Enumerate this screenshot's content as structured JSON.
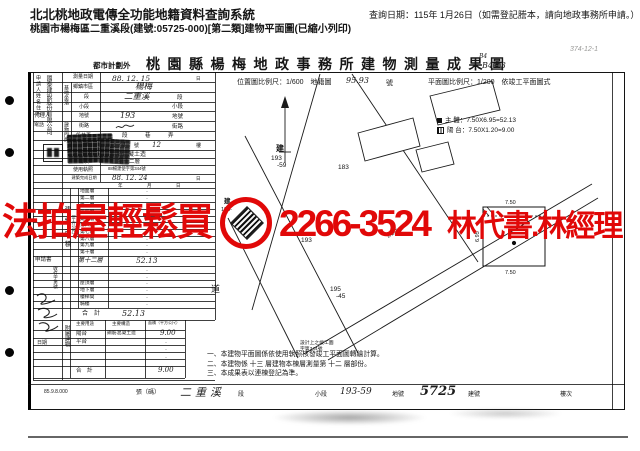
{
  "header": {
    "system_title": "北北桃地政電傳全功能地籍資料查詢系統",
    "query_date": "查詢日期：115年 1月26日（如需登記謄本，請向地政事務所申請。）",
    "subtitle": "桃園市楊梅區二重溪段(建號:05725-000)[第二類]建物平面圖(已縮小列印)"
  },
  "document": {
    "plan_zone": "都市計劃外",
    "title": "桃園縣楊梅地政事務所建物測量成果圖",
    "handwritten_small": "B4",
    "handwritten_code": "B4-13",
    "pencil_note": "374-12-1"
  },
  "form": {
    "applicant_label": "申請人姓名住所",
    "applicant_value": "國泰建設股份有限公司",
    "agent_label": "代理人",
    "phone_label": "電話",
    "receipt_label": "申請書",
    "receipt_no_label": "收件字第號",
    "receipt_date_label": "日期",
    "survey_date": {
      "label": "測量日期",
      "value": "88. 12. 15",
      "unit": "日"
    },
    "site_label": "基地坐落",
    "township": {
      "label": "鄉鎮市區",
      "value": "楊梅"
    },
    "section": {
      "label": "段",
      "value": "二重溪",
      "suffix": "段"
    },
    "subsection": {
      "label": "小段",
      "suffix": "小段"
    },
    "lot": {
      "label": "地號",
      "value": "193",
      "suffix": "地號"
    },
    "address_label": "建物門牌",
    "street": {
      "label": "街路",
      "suffix": "街路"
    },
    "lane": {
      "label": "段巷弄",
      "suffix": "段 巷 弄"
    },
    "number": {
      "label": "號",
      "value": "374",
      "suffix": "號",
      "floor": "12",
      "floor_suffix": "樓"
    },
    "material": {
      "label": "主要建材",
      "value": "鋼筋混凝土造"
    },
    "storey": {
      "label": "層次",
      "value": "第十二層"
    },
    "license": {
      "label": "使用執照",
      "value": "88楊建使字第344號"
    },
    "completion": {
      "label": "建築完成日期",
      "value": "88. 12. 24",
      "unit": "日"
    },
    "date_units": "年　月　日",
    "area_label": "建物面積",
    "area_unit": "（平方公尺）",
    "floors": [
      {
        "name": "地面層",
        "area": "·"
      },
      {
        "name": "第二層",
        "area": "·"
      },
      {
        "name": "第三層",
        "area": "·"
      },
      {
        "name": "第四層",
        "area": "·"
      },
      {
        "name": "第五層",
        "area": "·"
      },
      {
        "name": "第六層",
        "area": "·"
      },
      {
        "name": "第七層",
        "area": "·"
      },
      {
        "name": "第八層",
        "area": "·"
      },
      {
        "name": "第九層",
        "area": "·"
      },
      {
        "name": "第十層",
        "area": "·"
      },
      {
        "name": "第十二層",
        "area": "52.13"
      },
      {
        "name": "",
        "area": "·"
      },
      {
        "name": "",
        "area": "·"
      },
      {
        "name": "屋頂層",
        "area": "·"
      },
      {
        "name": "地下層",
        "area": "·"
      },
      {
        "name": "樓梯間",
        "area": "·"
      },
      {
        "name": "騎樓",
        "area": "·"
      }
    ],
    "total_label": "合　計",
    "total_value": "52.13",
    "annex_label": "附屬建物",
    "annex_headers": [
      "主要用途",
      "主要構造",
      "面積（平方公尺）"
    ],
    "annex_rows": [
      {
        "use": "陽台",
        "structure": "鋼筋混凝土造",
        "area": "9.00"
      },
      {
        "use": "平台",
        "structure": "",
        "area": "·"
      },
      {
        "use": "",
        "structure": "",
        "area": "·"
      },
      {
        "use": "",
        "structure": "",
        "area": "·"
      }
    ],
    "annex_total_label": "合　計",
    "annex_total_value": "9.00",
    "print_code": "85.9.8.000"
  },
  "plan": {
    "position_scale": "位置圖比例尺：1/600　地籍圖",
    "position_sheet": "95.93",
    "position_sheet_suffix": "號",
    "floor_scale": "平面圖比例尺：1/200　依竣工平面圖式",
    "legend": [
      {
        "label": "主 體",
        "formula": "7.50X6.95=52.13"
      },
      {
        "label": "陽 台",
        "formula": "7.50X1.20=9.00"
      }
    ],
    "labels": {
      "parcel_build": "建",
      "parcel_no": "193",
      "parcel_sub": "-59",
      "p183": "183",
      "p193": "193",
      "p195": "195",
      "p195b": "-45",
      "road": "道",
      "road_small": "計劃道路",
      "build_small": "建",
      "build_small_no": "193-"
    },
    "dims": {
      "top": "7.50",
      "bottom": "7.50",
      "left": "6.95"
    }
  },
  "notes": {
    "annotation_line1": "設計上之竣工圖",
    "annotation_line2": "字第344號",
    "item1": "一、本建物平面圖係依使用執照核發竣工平面圖轉繪計算。",
    "item2": "二、本建物係 十三 層建物本棟層測量第 十二 層部份。",
    "item3": "三、本成果表以連棟登記為準。"
  },
  "footer": {
    "page_label": "張（碼）",
    "section_value": "二重溪",
    "section_label": "段",
    "subsection_label": "小段",
    "lot_value": "193-59",
    "lot_label": "地號",
    "building_value": "5725",
    "building_label": "建號",
    "floor_label": "樓次"
  },
  "watermark": {
    "text_left": "法拍屋輕鬆買",
    "phone": "2266-3524",
    "text_right": "林代書.林經理",
    "color": "#e10808",
    "icon": "diamond-badge"
  }
}
